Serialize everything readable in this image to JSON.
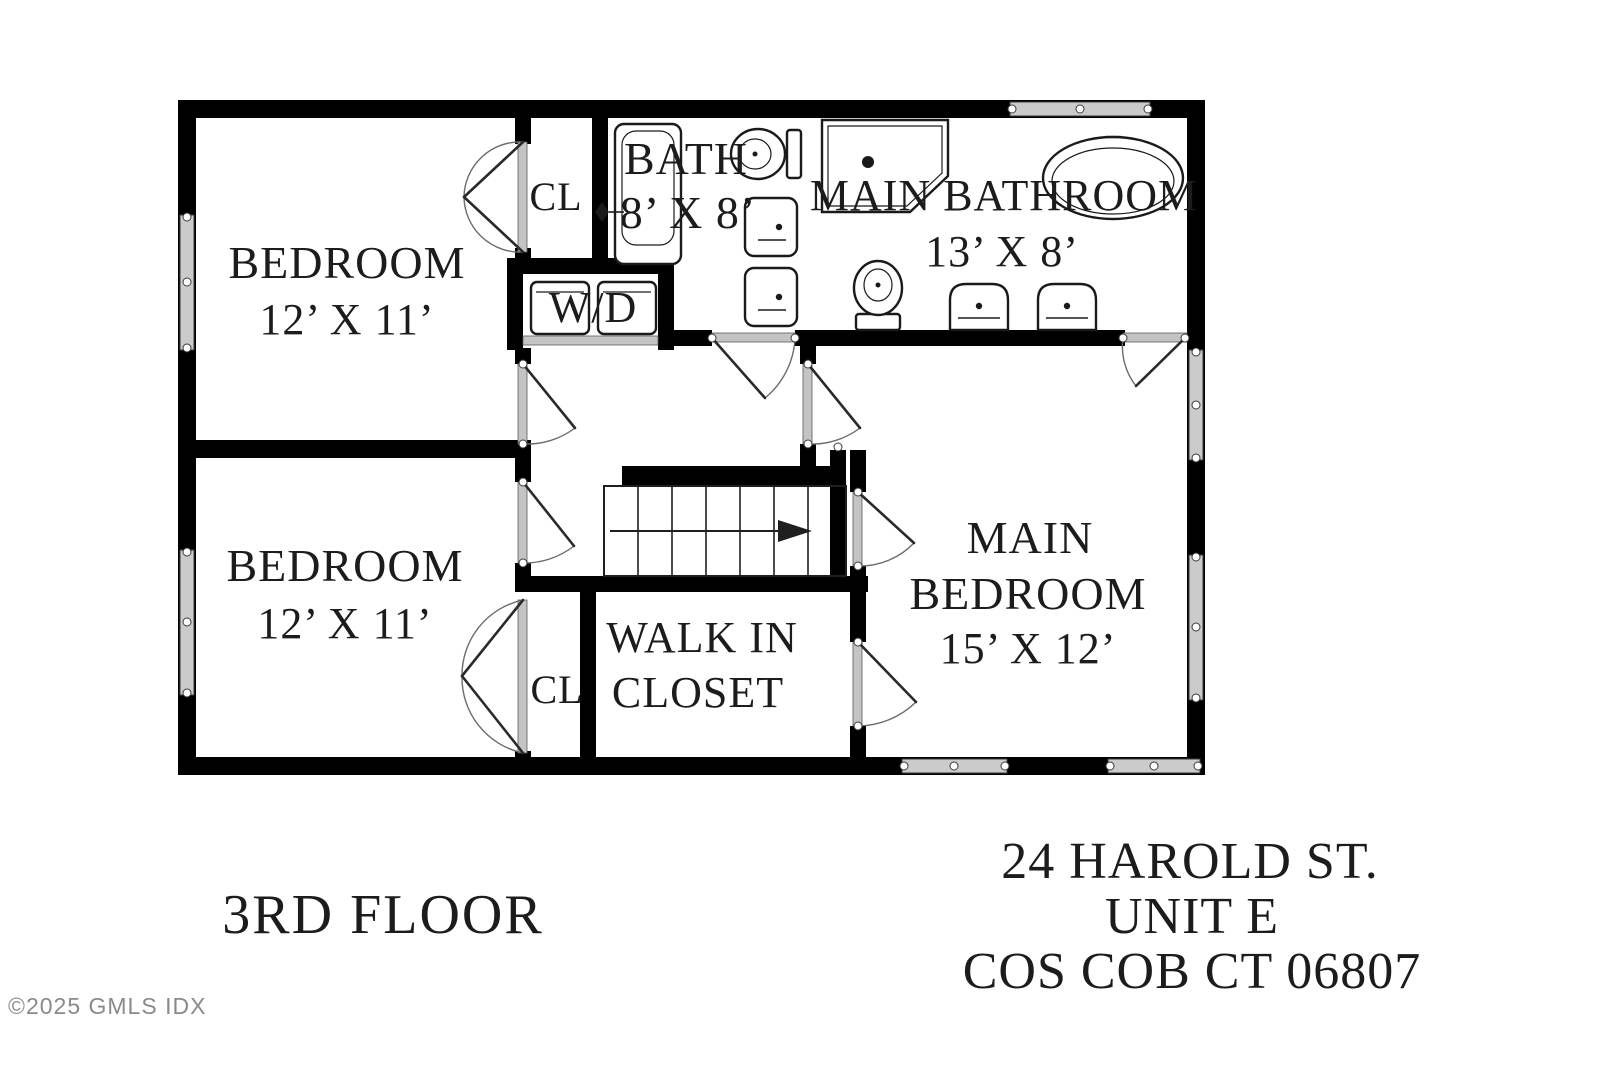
{
  "page": {
    "background": "#ffffff",
    "floor_title": "3RD FLOOR",
    "address": {
      "line1": "24 HAROLD ST.",
      "line2": "UNIT E",
      "line3": "COS COB CT 06807"
    },
    "copyright": "©2025 GMLS IDX"
  },
  "plan": {
    "rooms": {
      "bedroom_top": {
        "name": "BEDROOM",
        "dims": "12’ X 11’"
      },
      "bedroom_bottom": {
        "name": "BEDROOM",
        "dims": "12’ X 11’"
      },
      "bath": {
        "name": "BATH",
        "dims": "8’ X 8’"
      },
      "main_bathroom": {
        "name": "MAIN BATHROOM",
        "dims": "13’ X 8’"
      },
      "main_bedroom": {
        "name_line1": "MAIN",
        "name_line2": "BEDROOM",
        "dims": "15’ X 12’"
      },
      "walk_in_closet": {
        "name_line1": "WALK IN",
        "name_line2": "CLOSET"
      },
      "closet_top": {
        "name": "CL"
      },
      "closet_bottom": {
        "name": "CL"
      },
      "laundry": {
        "name": "W/D"
      }
    },
    "colors": {
      "wall": "#000000",
      "label_text": "#1c1c1c",
      "window_fill": "#cbcbcb",
      "door_jamb": "#c4c4c4",
      "door_arc": "#6b6b6b",
      "copyright_text": "#8a8a8a"
    },
    "icons": [
      "window-icon",
      "door-icon",
      "bifold-door-icon",
      "staircase-icon",
      "stair-direction-arrow-icon",
      "shower-icon",
      "soaking-tub-icon",
      "bathtub-icon",
      "toilet-icon",
      "vanity-sink-icon",
      "washer-icon",
      "dryer-icon",
      "faucet-icon"
    ]
  }
}
